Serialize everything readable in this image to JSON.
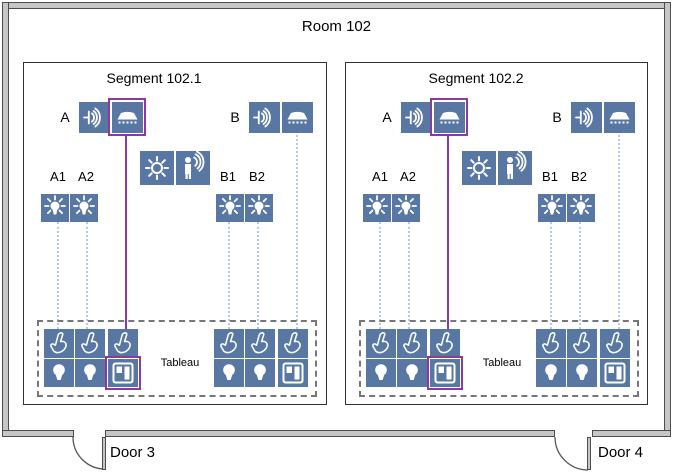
{
  "room": {
    "title": "Room 102"
  },
  "segments": [
    {
      "title": "Segment 102.1",
      "zone_a": {
        "label": "A",
        "devices": [
          "sounder-icon",
          "ceiling-shade-icon"
        ],
        "highlighted": true
      },
      "zone_b": {
        "label": "B",
        "devices": [
          "sounder-icon",
          "ceiling-shade-icon"
        ],
        "highlighted": false
      },
      "sensors": [
        "brightness-sun-icon",
        "presence-detector-icon"
      ],
      "lamp_labels_a": [
        "A1",
        "A2"
      ],
      "lamp_labels_b": [
        "B1",
        "B2"
      ],
      "tableau": {
        "label": "Tableau",
        "left_buttons": [
          {
            "top": "press-hand-icon",
            "bottom": "bulb-icon",
            "highlighted": false
          },
          {
            "top": "press-hand-icon",
            "bottom": "bulb-icon",
            "highlighted": false
          },
          {
            "top": "press-hand-icon",
            "bottom": "window-shutter-icon",
            "highlighted": true
          }
        ],
        "right_buttons": [
          {
            "top": "press-hand-icon",
            "bottom": "bulb-icon",
            "highlighted": false
          },
          {
            "top": "press-hand-icon",
            "bottom": "bulb-icon",
            "highlighted": false
          },
          {
            "top": "press-hand-icon",
            "bottom": "window-shutter-icon",
            "highlighted": false
          }
        ]
      }
    },
    {
      "title": "Segment 102.2",
      "zone_a": {
        "label": "A",
        "devices": [
          "sounder-icon",
          "ceiling-shade-icon"
        ],
        "highlighted": true
      },
      "zone_b": {
        "label": "B",
        "devices": [
          "sounder-icon",
          "ceiling-shade-icon"
        ],
        "highlighted": false
      },
      "sensors": [
        "brightness-sun-icon",
        "presence-detector-icon"
      ],
      "lamp_labels_a": [
        "A1",
        "A2"
      ],
      "lamp_labels_b": [
        "B1",
        "B2"
      ],
      "tableau": {
        "label": "Tableau",
        "left_buttons": [
          {
            "top": "press-hand-icon",
            "bottom": "bulb-icon",
            "highlighted": false
          },
          {
            "top": "press-hand-icon",
            "bottom": "bulb-icon",
            "highlighted": false
          },
          {
            "top": "press-hand-icon",
            "bottom": "window-shutter-icon",
            "highlighted": true
          }
        ],
        "right_buttons": [
          {
            "top": "press-hand-icon",
            "bottom": "bulb-icon",
            "highlighted": false
          },
          {
            "top": "press-hand-icon",
            "bottom": "bulb-icon",
            "highlighted": false
          },
          {
            "top": "press-hand-icon",
            "bottom": "window-shutter-icon",
            "highlighted": false
          }
        ]
      }
    }
  ],
  "doors": [
    {
      "label": "Door 3"
    },
    {
      "label": "Door 4"
    }
  ],
  "colors": {
    "device_blue": "#5878a3",
    "highlight_purple": "#8a3aa0",
    "connector_blue": "#b7c9e1",
    "wall_gray": "#c6c6c6",
    "wall_edge": "#4d4d4d"
  }
}
